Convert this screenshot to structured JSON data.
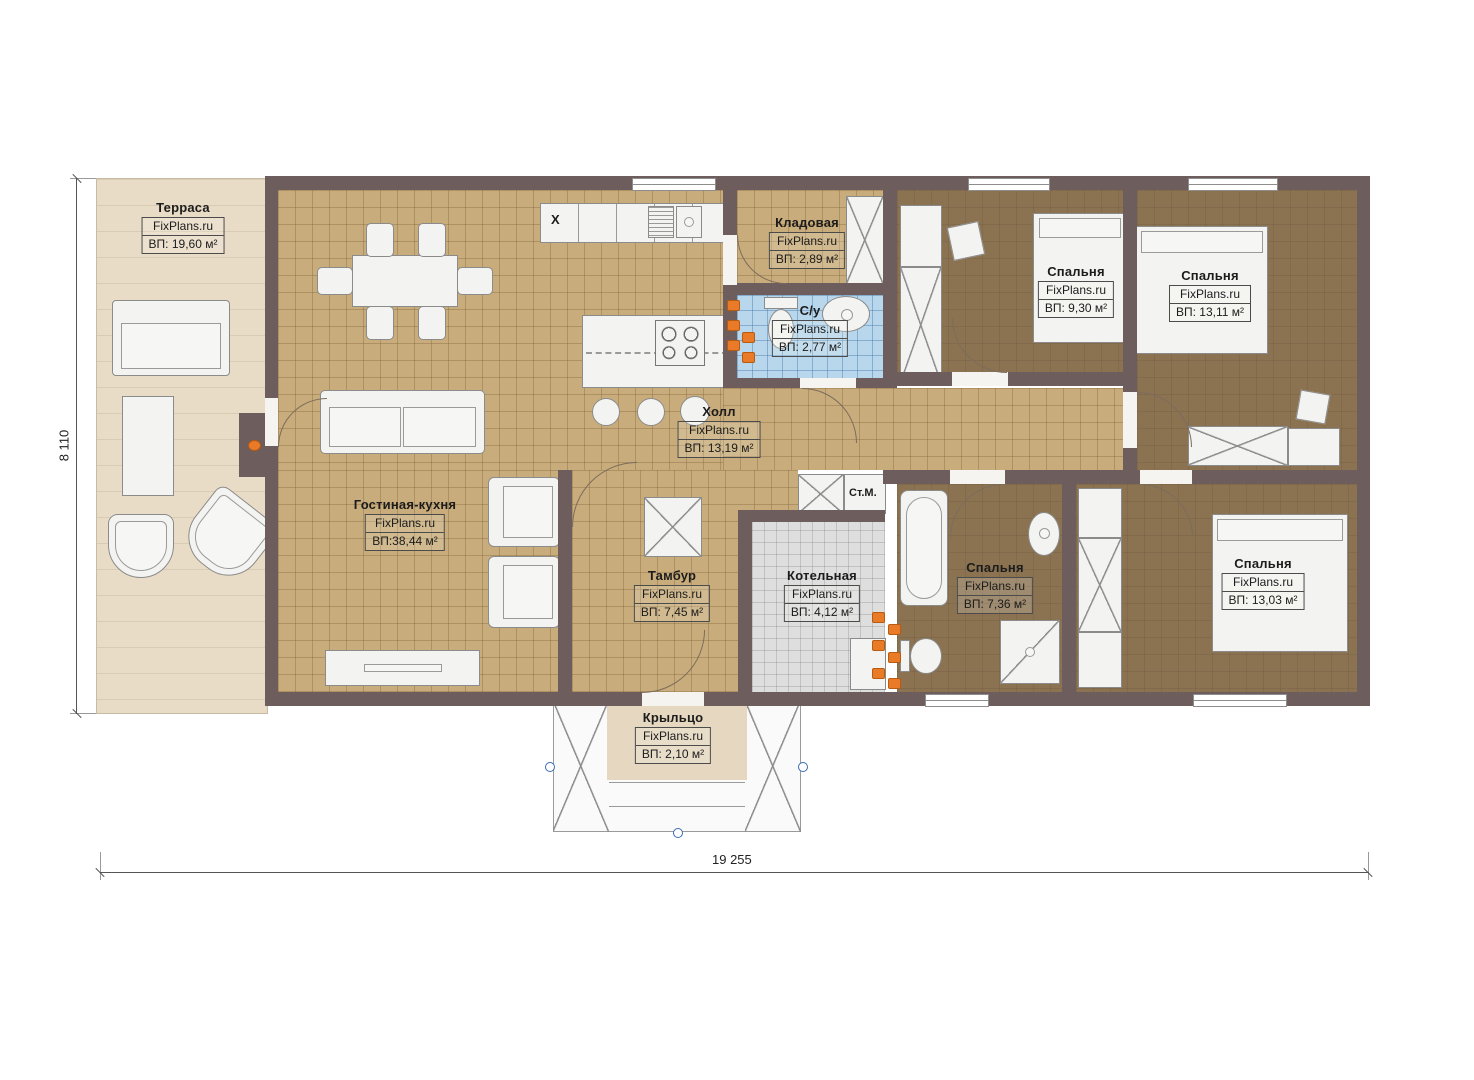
{
  "plan": {
    "width_dim": "19 255",
    "height_dim": "8 110",
    "brand": "FixPlans.ru"
  },
  "rooms": [
    {
      "id": "terrace",
      "name": "Терраса",
      "brand": "FixPlans.ru",
      "area": "ВП: 19,60 м²"
    },
    {
      "id": "storage",
      "name": "Кладовая",
      "brand": "FixPlans.ru",
      "area": "ВП: 2,89 м²"
    },
    {
      "id": "wc",
      "name": "С/у",
      "brand": "FixPlans.ru",
      "area": "ВП: 2,77 м²"
    },
    {
      "id": "bedroom-1",
      "name": "Спальня",
      "brand": "FixPlans.ru",
      "area": "ВП: 9,30 м²"
    },
    {
      "id": "bedroom-2",
      "name": "Спальня",
      "brand": "FixPlans.ru",
      "area": "ВП: 13,11 м²"
    },
    {
      "id": "hall",
      "name": "Холл",
      "brand": "FixPlans.ru",
      "area": "ВП: 13,19 м²"
    },
    {
      "id": "living-kitchen",
      "name": "Гостиная-кухня",
      "brand": "FixPlans.ru",
      "area": "ВП:38,44 м²"
    },
    {
      "id": "vestibule",
      "name": "Тамбур",
      "brand": "FixPlans.ru",
      "area": "ВП: 7,45 м²"
    },
    {
      "id": "boiler",
      "name": "Котельная",
      "brand": "FixPlans.ru",
      "area": "ВП: 4,12 м²"
    },
    {
      "id": "bathroom",
      "name": "Спальня",
      "brand": "FixPlans.ru",
      "area": "ВП: 7,36 м²"
    },
    {
      "id": "bedroom-3",
      "name": "Спальня",
      "brand": "FixPlans.ru",
      "area": "ВП: 13,03 м²"
    },
    {
      "id": "porch",
      "name": "Крыльцо",
      "brand": "FixPlans.ru",
      "area": "ВП: 2,10 м²"
    }
  ],
  "annotations": {
    "washing_machine": "Ст.М.",
    "appliance_mark": "X"
  },
  "colors": {
    "wall": "#6e5d5d",
    "floor_tan": "#c9ac7b",
    "floor_dark": "#8b7352",
    "floor_blue": "#b9d7ec",
    "floor_gray": "#dedede",
    "terrace": "#e9dcc6",
    "accent_orange": "#e87a28",
    "handle_blue": "#3a6cb5"
  }
}
